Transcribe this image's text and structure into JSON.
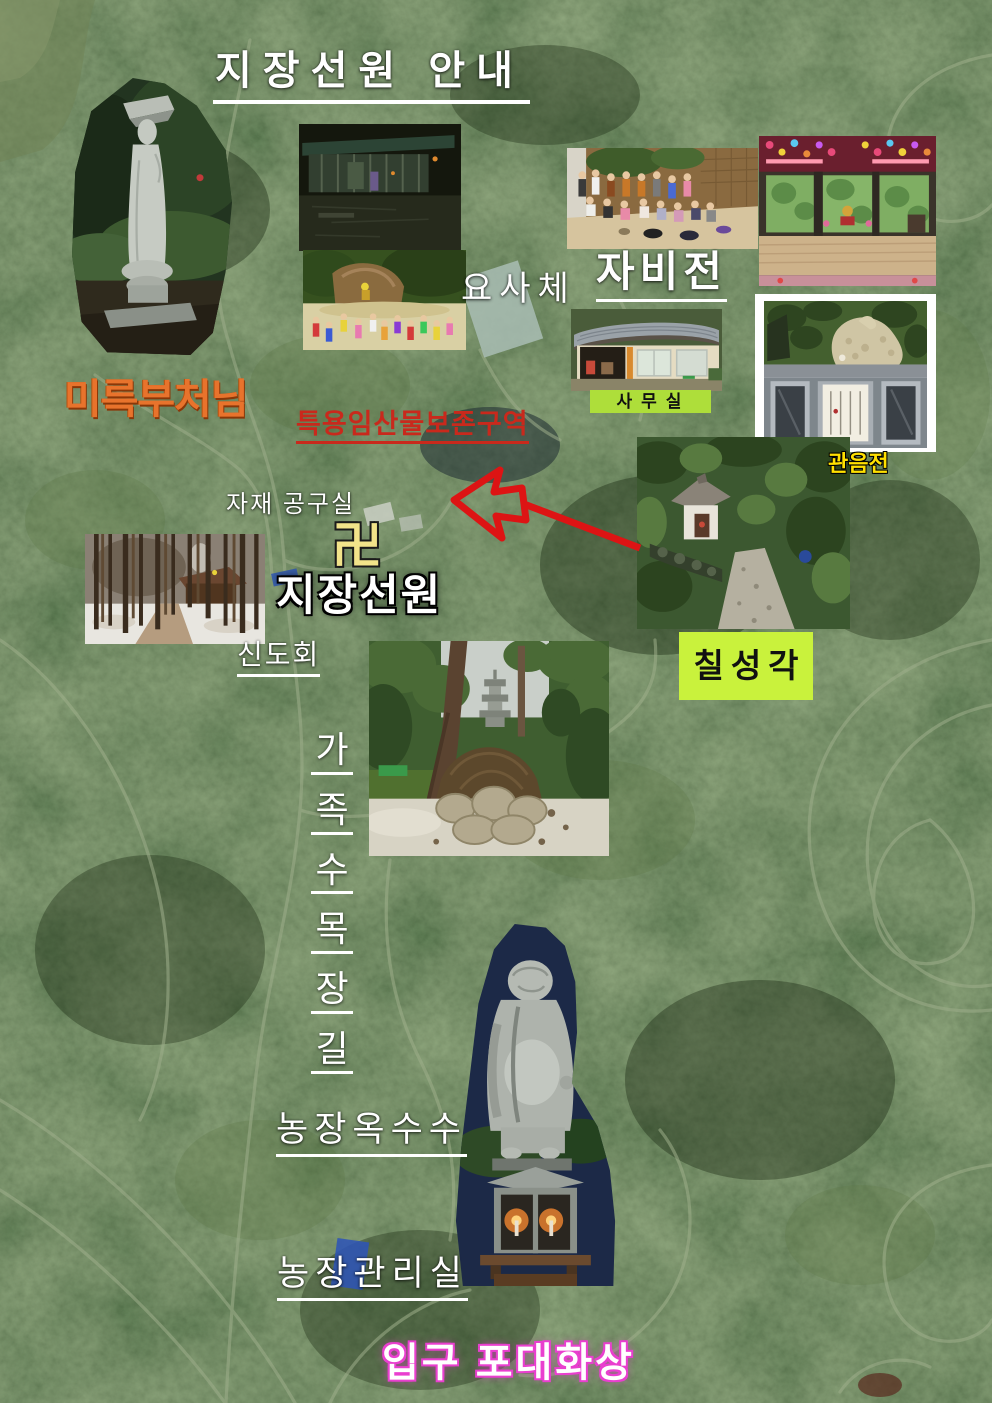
{
  "poster": {
    "title": "지장선원 안내"
  },
  "labels": {
    "maitreya_buddha": "미륵부처님",
    "forest_preservation_zone": "특용임산물보존구역",
    "dormitory": "요사체",
    "jabijeon_hall": "자비전",
    "office": "사무실",
    "gwaneumjeon_hall": "관음전",
    "materials_tool_room": "자재 공구실",
    "manji_symbol": "卍",
    "temple_name": "지장선원",
    "devotees_association": "신도회",
    "chilseonggak_shrine": "칠성각",
    "family_tree_burial_path": [
      "가",
      "족",
      "수",
      "목",
      "장",
      "길"
    ],
    "farm_corn": "농장옥수수",
    "farm_management_office": "농장관리실",
    "entrance_budai_statue": "입구 포대화상"
  },
  "colors": {
    "title_text": "#ffffff",
    "maitreya_text": "#e8732c",
    "preservation_text": "#c9291c",
    "office_label_bg": "#aede3a",
    "gwaneum_text": "#ffe000",
    "chilseong_label_bg": "#c9f23c",
    "manji_text": "#f2e38a",
    "entrance_outline": "#e93fcf",
    "arrow": "#dd1414"
  }
}
